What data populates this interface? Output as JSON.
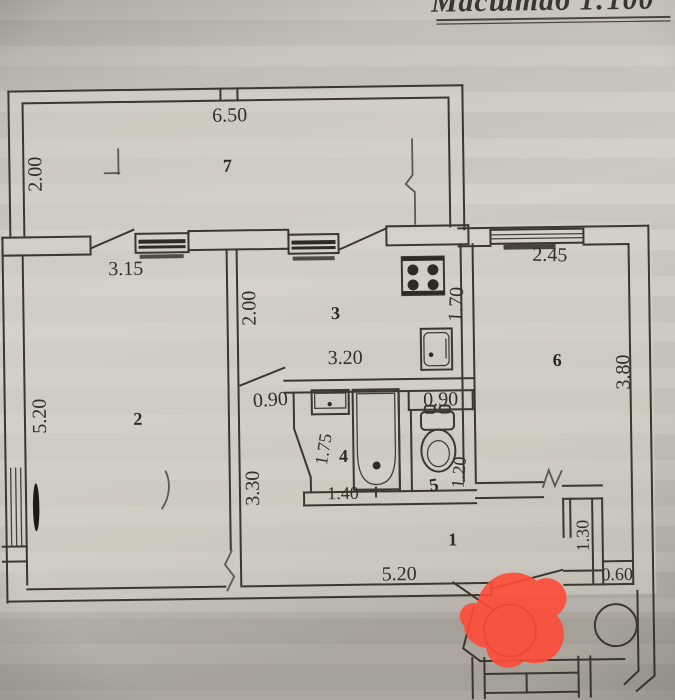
{
  "scale_note": "Масштаб 1:100",
  "rooms": {
    "balcony": "7",
    "living": "2",
    "kitchen": "3",
    "bath": "4",
    "wc": "5",
    "bedroom": "6",
    "hall": "1"
  },
  "dims": {
    "balcony_width": "6.50",
    "balcony_depth": "2.00",
    "living_width": "3.15",
    "living_height": "5.20",
    "living_wall": "3.30",
    "kitchen_depth": "2.00",
    "kitchen_width": "3.20",
    "kitchen_side": "1.70",
    "bedroom_width": "2.45",
    "bedroom_height": "3.80",
    "bath_door": "0.90",
    "wc_door": "0.90",
    "bath_depth": "1.75",
    "bath_width": "1.40",
    "wc_depth": "1.20",
    "closet_depth": "1.30",
    "closet_width": "0.60",
    "hall_width": "5.20"
  },
  "colors": {
    "ink": "#3c362e",
    "marker_red": "#ff4b38",
    "paper": "#cdc8bf"
  }
}
